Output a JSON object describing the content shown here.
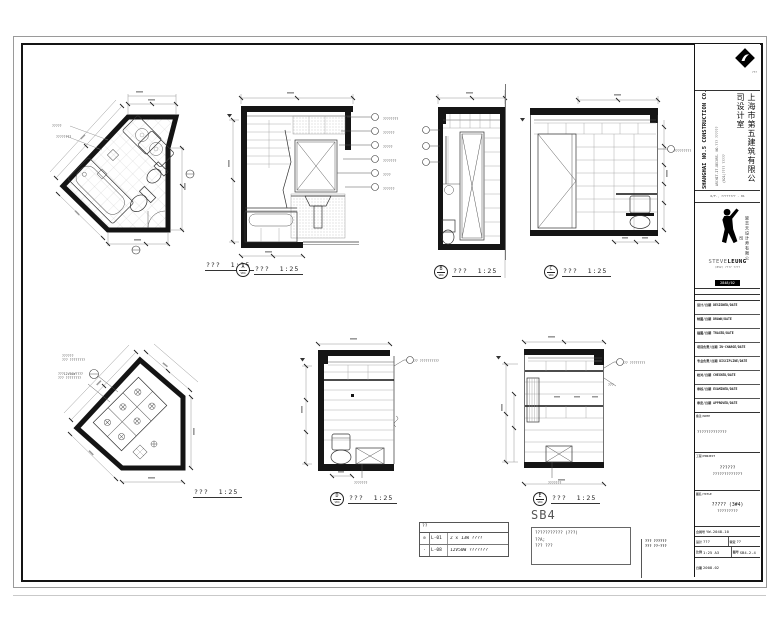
{
  "sheet": {
    "drawings": {
      "plan": {
        "title": "???",
        "scale": "1:25",
        "callouts": [
          {
            "x": 2,
            "y": 46,
            "text": "?????"
          },
          {
            "x": 6,
            "y": 57,
            "text": "????????"
          }
        ]
      },
      "elev_a": {
        "bubble": "A",
        "sheet_no": "SB4",
        "title": "???",
        "scale": "1:25",
        "callouts": [
          {
            "x": 156,
            "y": 27,
            "text": "????????"
          },
          {
            "x": 156,
            "y": 41,
            "text": "??????"
          },
          {
            "x": 156,
            "y": 55,
            "text": "?????"
          },
          {
            "x": 156,
            "y": 69,
            "text": "???????"
          },
          {
            "x": 156,
            "y": 83,
            "text": "????"
          },
          {
            "x": 156,
            "y": 97,
            "text": "??????"
          }
        ]
      },
      "elev_b": {
        "bubble": "B",
        "sheet_no": "SB4",
        "title": "???",
        "scale": "1:25",
        "callouts": []
      },
      "elev_c": {
        "bubble": "C",
        "sheet_no": "SB4",
        "title": "???",
        "scale": "1:25",
        "callouts": [
          {
            "x": 156,
            "y": 59,
            "text": "?????????"
          }
        ]
      },
      "ceiling": {
        "title": "???",
        "scale": "1:25",
        "callouts": [
          {
            "x": 4,
            "y": 18,
            "text": "??????\n??? ????????"
          },
          {
            "x": 0,
            "y": 36,
            "text": "???12V50W????\n??? ????????"
          }
        ]
      },
      "elev_d": {
        "bubble": "D",
        "sheet_no": "SB4",
        "title": "???",
        "scale": "1:25",
        "callouts": [
          {
            "x": 118,
            "y": 23,
            "text": "?? ??????????"
          },
          {
            "x": 58,
            "y": 145,
            "text": "???????"
          }
        ]
      },
      "elev_e": {
        "bubble": "E",
        "sheet_no": "SB4",
        "title": "???",
        "scale": "1:25",
        "callouts": [
          {
            "x": 136,
            "y": 27,
            "text": "?? ????????"
          },
          {
            "x": 120,
            "y": 49,
            "text": "???"
          },
          {
            "x": 60,
            "y": 147,
            "text": "???????"
          }
        ]
      }
    },
    "legend": {
      "header": "??",
      "rows": [
        {
          "symbol": "⊘",
          "code": "L-01",
          "desc": "2 x 13W ????"
        },
        {
          "symbol": "·",
          "code": "L-08",
          "desc": "12V50W ???????"
        }
      ]
    },
    "sb4_note": {
      "title": "SB4",
      "lines": "??????????? (???)\n??A;\n??? ???"
    },
    "corner_note": {
      "line1": "??? ??????",
      "line2": "??? ??-???"
    }
  },
  "titleblock": {
    "logo_caption": "???",
    "company_en": "SHANGHAI NO.5 CONSTRUCTION CO.,LTD",
    "company_addr": "ARCHIT.IT.DECORS. NO.??? ??????",
    "company_tel": "(021)???? ?????",
    "company_cn": "上海市第五建筑有限公司设计室",
    "branch_line": "6/F., ???????? - 01",
    "designer_cn": "梁志天设计师有限公司",
    "designer_en1": "STEVE",
    "designer_en2": "LEUNG",
    "designer_sub": "(852) ???? ????",
    "badge": "2848/02",
    "badge_sub": "???????",
    "sign_rows": [
      "设计/日期 DESIGNED/DATE",
      "制图/日期 DRAWN/DATE",
      "描图/日期 TRACED/DATE",
      "项目负责/日期 IN-CHARGE/DATE",
      "专业负责/日期 DISCIPLINE/DATE",
      "校对/日期 CHECKED/DATE",
      "审核/日期 EXAMINED/DATE",
      "审定/日期 APPROVED/DATE"
    ],
    "note_label": "备注/NOTE",
    "note_value": "?????????????",
    "client_label": "工程/PROJECT",
    "client_line1": "??????",
    "client_line2": "?????????????",
    "dwg_label": "图名/TITLE",
    "dwg_line1": "????? (3#4)",
    "dwg_line2": "?????????",
    "contract_label": "合同号",
    "contract_value": "YW-2048-10",
    "design_label": "设计",
    "design_value": "???",
    "approve_label": "审定",
    "approve_value": "??",
    "scale_label": "比例",
    "scale_value": "1:25  A3",
    "dwgno_label": "图号",
    "dwgno_value": "SB4-2-4",
    "date_label": "日期",
    "date_value": "2008.02"
  }
}
